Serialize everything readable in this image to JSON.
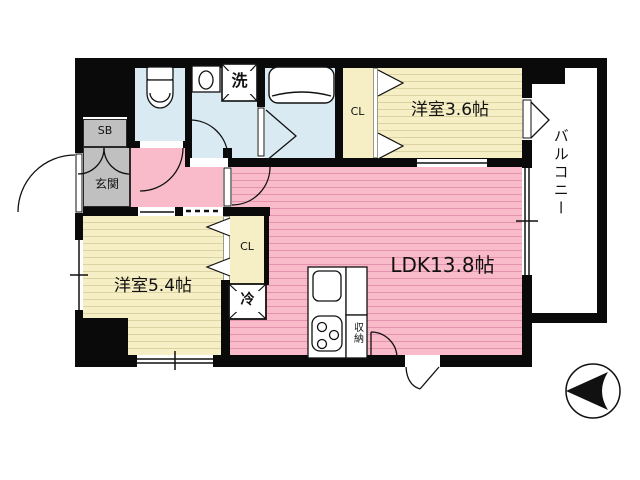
{
  "plan_title": "apartment-floor-plan",
  "rooms": {
    "ldk": {
      "label": "LDK13.8帖"
    },
    "western_room_upper": {
      "label": "洋室3.6帖"
    },
    "western_room_lower": {
      "label": "洋室5.4帖"
    },
    "balcony": {
      "label": "バルコニー"
    },
    "entrance": {
      "label": "玄関"
    },
    "shoe_box": {
      "label": "SB"
    },
    "closet_upper": {
      "label": "CL"
    },
    "closet_lower": {
      "label": "CL"
    }
  },
  "fixtures": {
    "washing_machine": {
      "label": "洗"
    },
    "refrigerator": {
      "label": "冷"
    },
    "storage": {
      "label": "収納"
    }
  },
  "icons": {
    "compass": "north-arrow-pointing-left"
  },
  "colors": {
    "wall": "#0a0a0a",
    "ldk_pink": "#F9BACA",
    "ldk_pink_stripe": "#E493AE",
    "room_cream": "#F6EFC6",
    "room_cream_stripe": "#DBD3A3",
    "wet_area_blue": "#D9EAF2",
    "entrance_gray": "#C1C0C0"
  }
}
